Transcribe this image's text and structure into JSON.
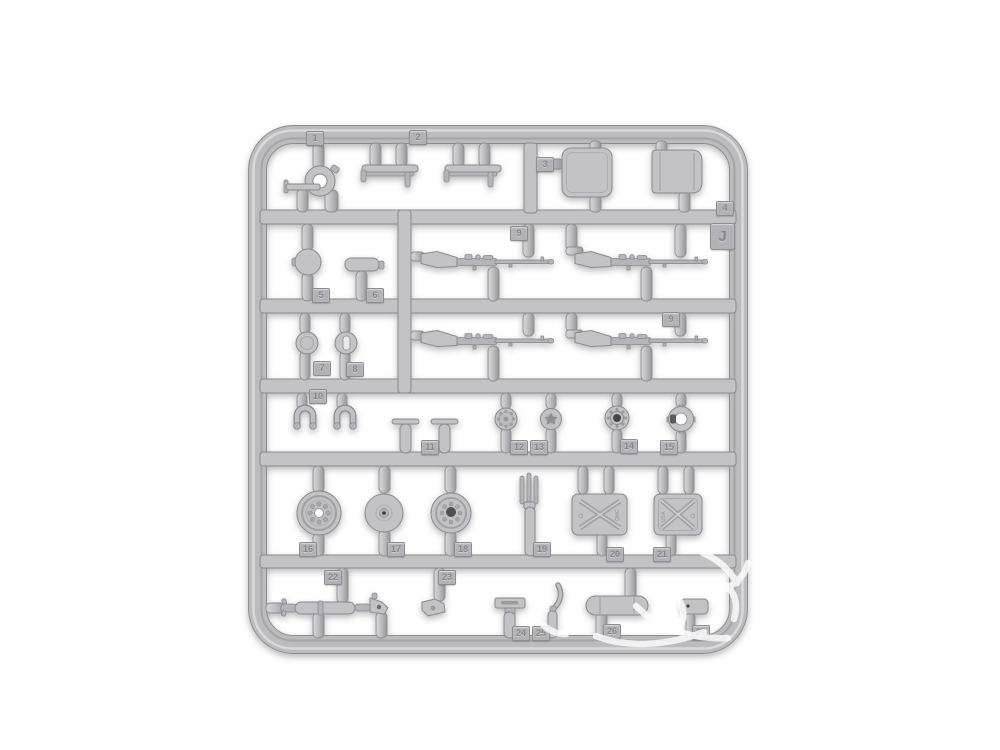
{
  "colors": {
    "background": "#ffffff",
    "plastic": "#c3c3c6",
    "plastic-dark": "#a9a9ad",
    "plastic-light": "#dadadc",
    "edge": "#8a8a8e",
    "watermark": "#ffffff"
  },
  "sprue": {
    "letter_tag": "J",
    "part_tags": {
      "p1": "1",
      "p2": "2",
      "p3": "3",
      "p4": "4",
      "p5": "5",
      "p6": "6",
      "p7": "7",
      "p8": "8",
      "p9_top": "9",
      "p9_bottom": "9",
      "p10": "10",
      "p11": "11",
      "p12": "12",
      "p13": "13",
      "p14": "14",
      "p15": "15",
      "p16": "16",
      "p17": "17",
      "p18": "18",
      "p19": "19",
      "p20": "20",
      "p21": "21",
      "p22": "22",
      "p23": "23",
      "p24": "24",
      "p25": "25",
      "p26": "26",
      "p27": "27"
    },
    "embossed": {
      "can20_left": "G",
      "can20_right": "QMC",
      "can21_left": "USA",
      "can21_right": "G"
    }
  }
}
